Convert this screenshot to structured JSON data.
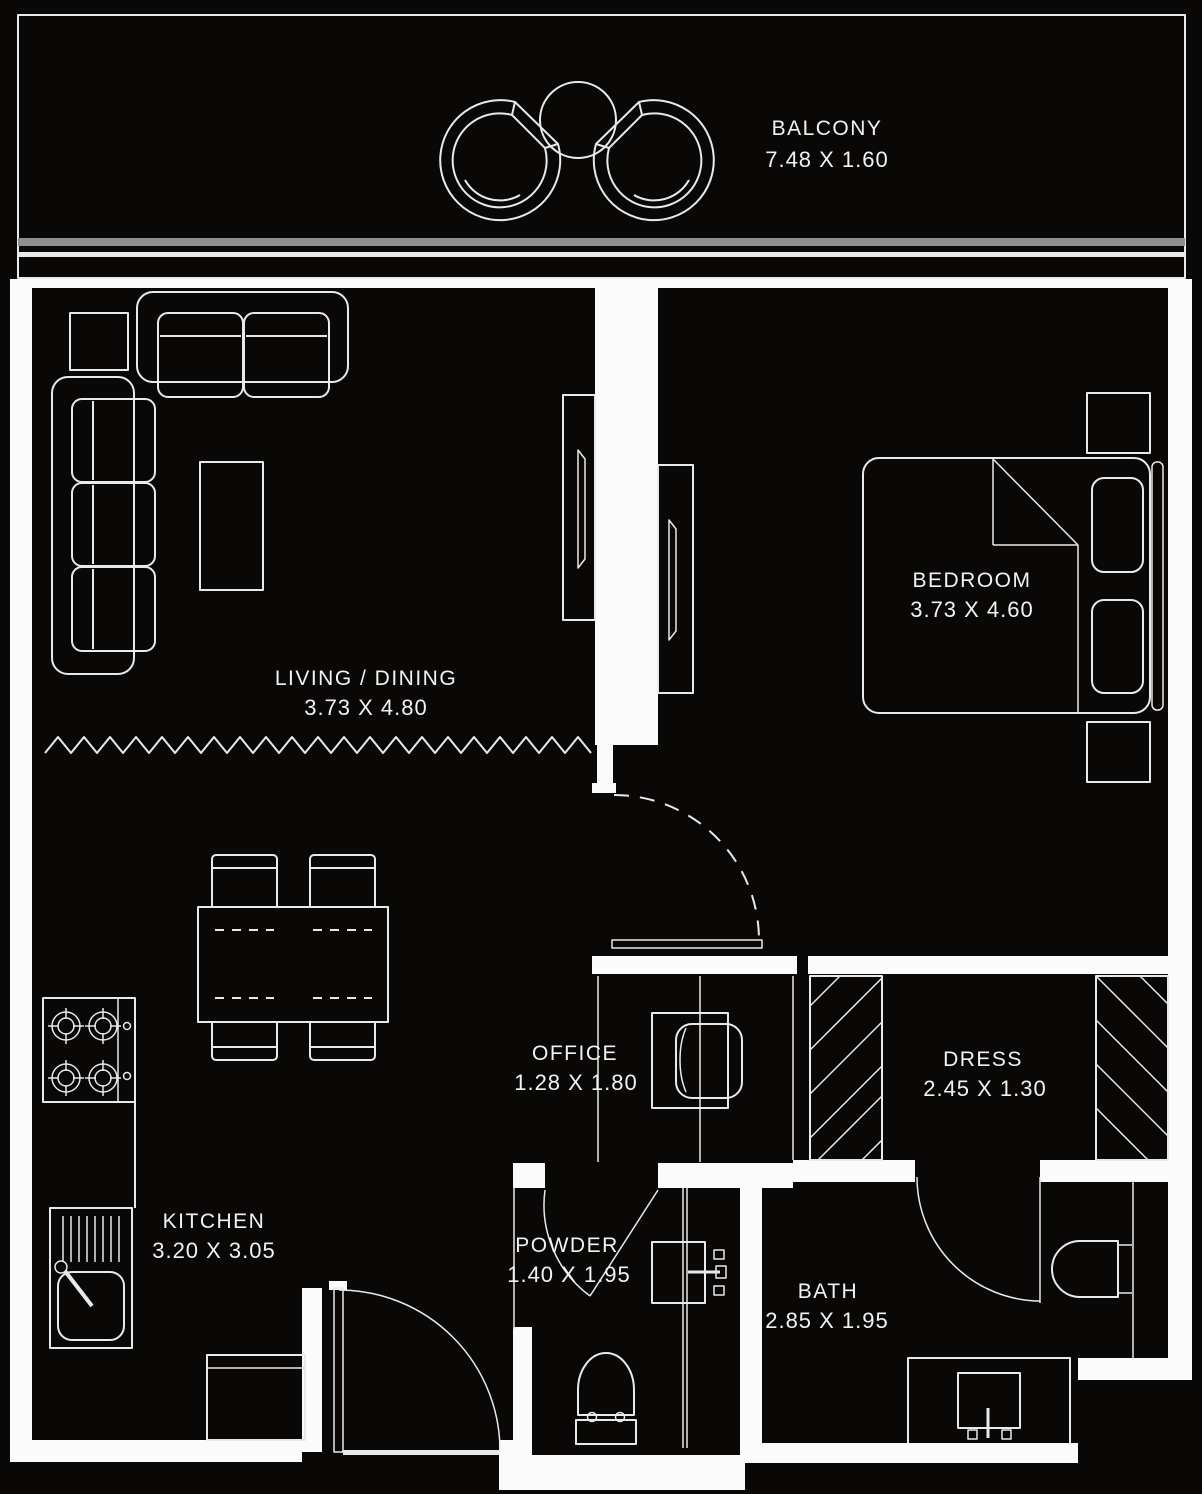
{
  "title": "Apartment floor plan",
  "colors": {
    "background": "#0a0807",
    "line": "#e9e9e9",
    "wall": "#fbfbfb",
    "balcony_glass": "#8f8f8f",
    "text": "#f2f2f2"
  },
  "rooms": [
    {
      "id": "balcony",
      "name": "BALCONY",
      "dimensions": "7.48 X 1.60"
    },
    {
      "id": "living-dining",
      "name": "LIVING / DINING",
      "dimensions": "3.73 X 4.80"
    },
    {
      "id": "bedroom",
      "name": "BEDROOM",
      "dimensions": "3.73 X 4.60"
    },
    {
      "id": "office",
      "name": "OFFICE",
      "dimensions": "1.28 X 1.80"
    },
    {
      "id": "dress",
      "name": "DRESS",
      "dimensions": "2.45 X 1.30"
    },
    {
      "id": "kitchen",
      "name": "KITCHEN",
      "dimensions": "3.20 X 3.05"
    },
    {
      "id": "powder",
      "name": "POWDER",
      "dimensions": "1.40 X 1.95"
    },
    {
      "id": "bath",
      "name": "BATH",
      "dimensions": "2.85 X 1.95"
    }
  ],
  "furniture_symbols": [
    "lounge-chair",
    "round-table",
    "sectional-sofa",
    "side-table",
    "coffee-table",
    "tv-unit",
    "double-bed",
    "pillow",
    "nightstand",
    "headboard",
    "dining-table",
    "dining-chair",
    "stove",
    "kitchen-sink",
    "fridge-cabinet",
    "desk",
    "office-chair",
    "wardrobe-hatch",
    "washbasin",
    "toilet",
    "vanity-sink",
    "door-swing",
    "sliding-door",
    "floor-break-line"
  ]
}
